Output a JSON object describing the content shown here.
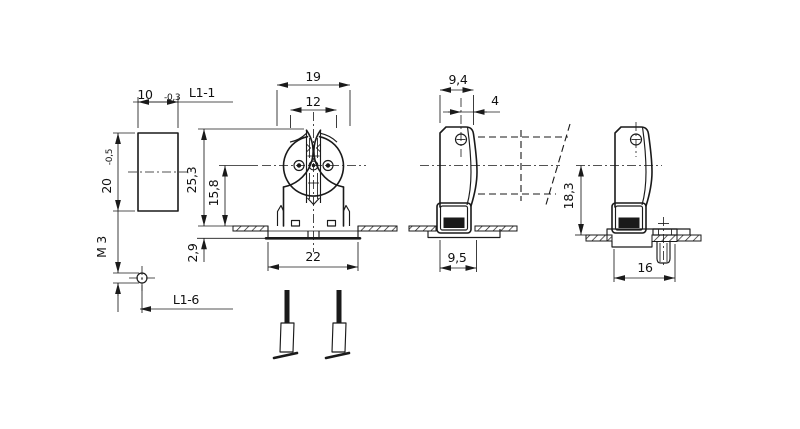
{
  "drawing": {
    "background": "#ffffff",
    "line_color": "#1a1a1a",
    "views": {
      "pin_plate": {
        "width": "10",
        "width_tol": "-0,3",
        "height": "20",
        "height_tol": "-0,5",
        "length_ref": "L1-1"
      },
      "stud": {
        "thread": "M 3",
        "length_ref": "L1-6"
      },
      "front": {
        "body_width": "19",
        "slot_width": "12",
        "height_above_panel": "25,3",
        "axis_height": "15,8",
        "depth_below_panel": "2,9",
        "base_width": "22"
      },
      "side": {
        "body_depth": "9,4",
        "hole_to_face": "4",
        "latch_width": "9,5"
      },
      "side_mounted": {
        "axis_height": "18,3",
        "base_depth": "16"
      }
    }
  }
}
